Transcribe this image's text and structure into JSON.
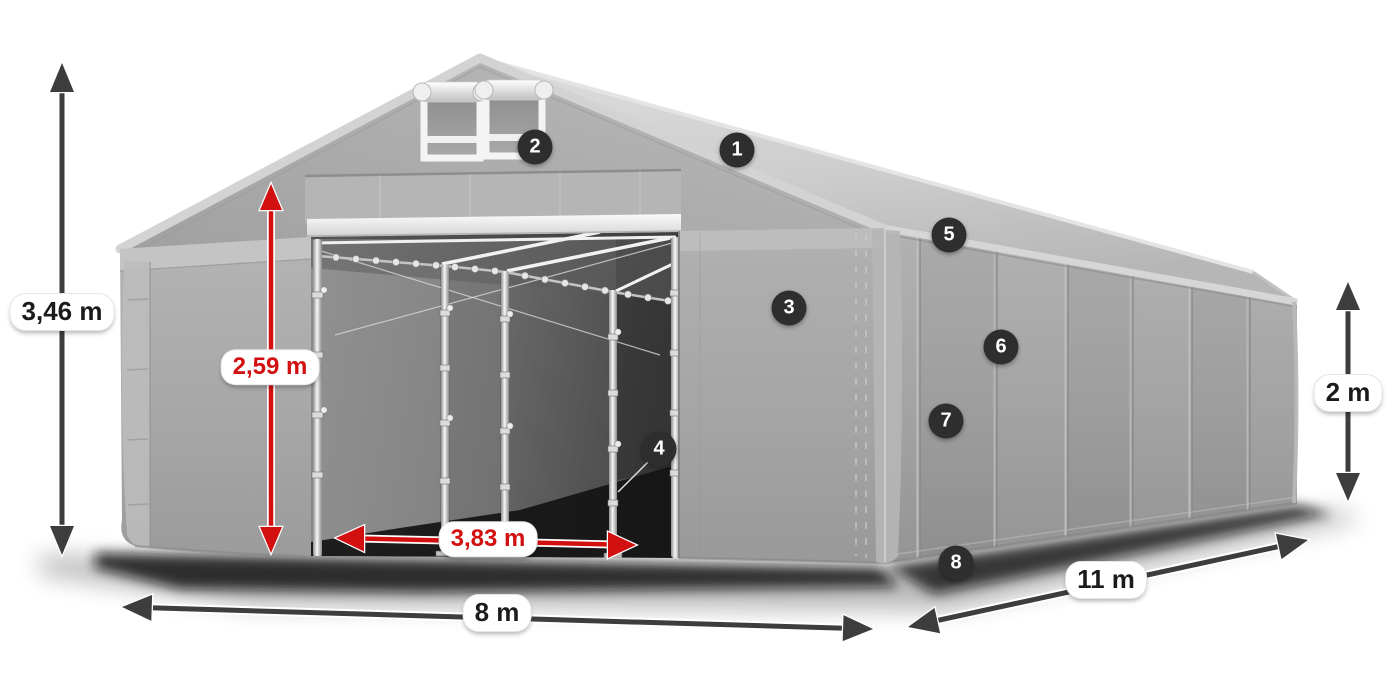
{
  "figure": {
    "description": "3D illustration of a grey tarpaulin storage tent with open front entrance, two roof vents, dimension arrows and numbered feature markers",
    "colors": {
      "accent_red": "#d21010",
      "dimension_arrow_dark": "#3d3d3d",
      "badge_background": "#2e2e2e",
      "badge_text": "#ffffff",
      "tent_roof_light": "#d8d8d8",
      "tent_wall_mid": "#a8a8a8",
      "interior_dark": "#3c3c3c",
      "label_background": "#ffffff"
    }
  },
  "dimensions": {
    "total_height": "3,46 m",
    "door_height": "2,59 m",
    "door_width": "3,83 m",
    "front_width": "8 m",
    "side_length": "11 m",
    "side_wall_height": "2 m"
  },
  "badges": [
    {
      "number": "1"
    },
    {
      "number": "2"
    },
    {
      "number": "3"
    },
    {
      "number": "4"
    },
    {
      "number": "5"
    },
    {
      "number": "6"
    },
    {
      "number": "7"
    },
    {
      "number": "8"
    }
  ]
}
